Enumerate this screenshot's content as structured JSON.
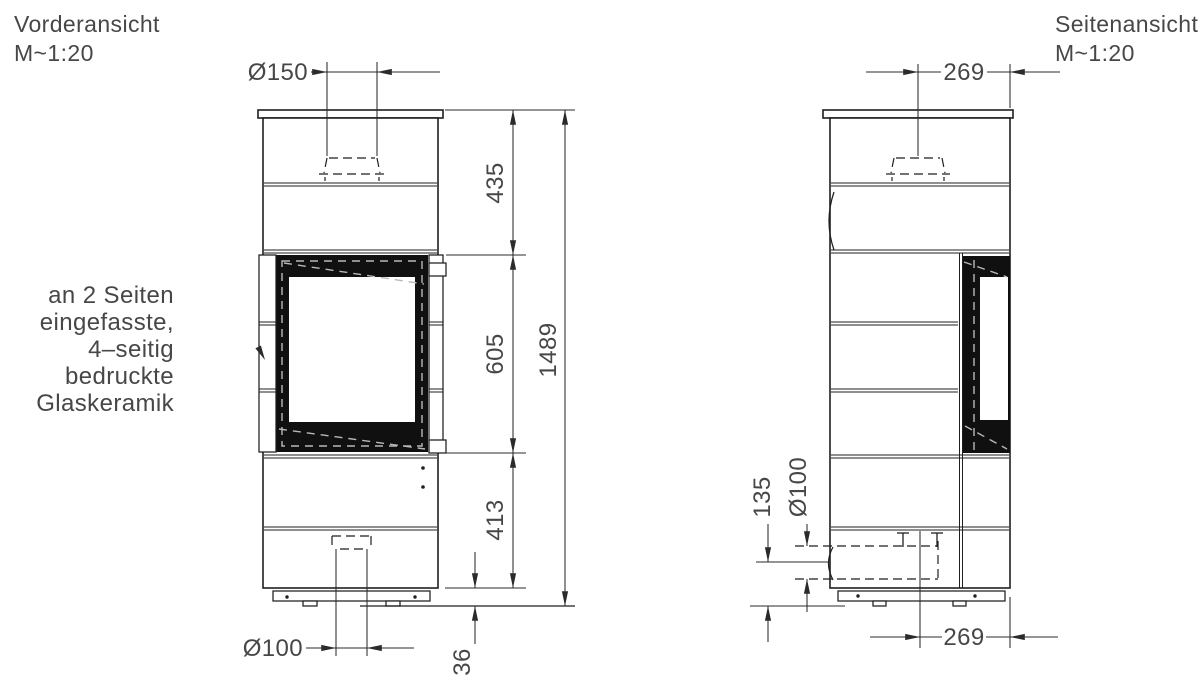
{
  "colors": {
    "line": "#1f1f1f",
    "text": "#474747",
    "glass_fill": "#101010",
    "background": "#ffffff"
  },
  "drawing": {
    "front_view": {
      "title": "Vorderansicht",
      "scale_label": "M~1:20",
      "dimensions": {
        "flue_diameter": "Ø150",
        "top_to_window_top": "435",
        "window_height": "605",
        "window_bottom_to_base": "413",
        "total_height": "1489",
        "air_inlet_diameter": "Ø100",
        "base_clearance": "36"
      },
      "glass_note_lines": [
        "an 2 Seiten",
        "eingefasste,",
        "4–seitig",
        "bedruckte",
        "Glaskeramik"
      ]
    },
    "side_view": {
      "title": "Seitenansicht",
      "scale_label": "M~1:20",
      "dimensions": {
        "flue_center_to_back": "269",
        "air_inlet_center_height": "135",
        "air_inlet_diameter": "Ø100",
        "air_inlet_center_to_back": "269"
      }
    }
  }
}
